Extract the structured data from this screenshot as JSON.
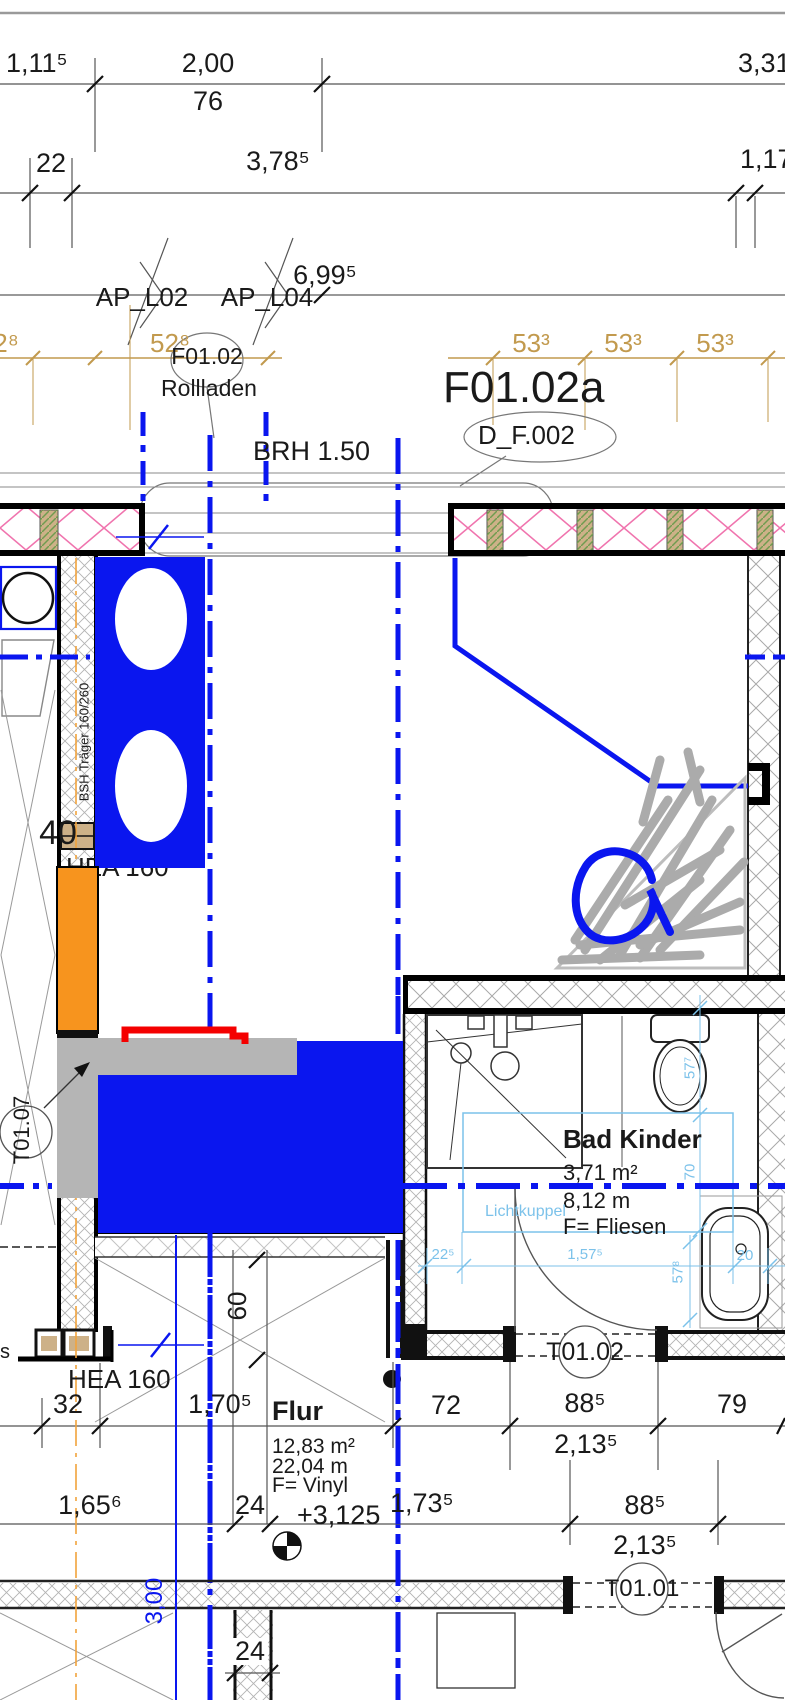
{
  "top_dims": {
    "r1a": "1,11⁵",
    "r1b": "2,00",
    "r1b_sub": "76",
    "r1c": "3,31",
    "r2a": "22",
    "r2b": "3,78⁵",
    "r2c": "1,17",
    "r3a": "6,99⁵"
  },
  "ap_labels": {
    "l02": "AP_L02",
    "l04": "AP_L04"
  },
  "gold_dims": {
    "g0": "2⁸",
    "g1": "52⁸",
    "g2": "53³",
    "g3": "53³",
    "g4": "53³"
  },
  "window": {
    "tag": "F01.02",
    "shutter": "Rollladen",
    "sill": "BRH 1.50",
    "tag_a": "F01.02a",
    "door_ref": "D_F.002"
  },
  "beams": {
    "bsh": "BSH Träger 160/260",
    "hea_hidden": "HEA 160",
    "hea": "HEA 160",
    "w40": "40",
    "d60": "60"
  },
  "doors": {
    "t0107": "T01.07",
    "t0102": "T01.02",
    "t0101": "T01.01"
  },
  "bath": {
    "name": "Bad Kinder",
    "area": "3,71 m²",
    "perim": "8,12 m",
    "floor": "F= Fliesen",
    "skylight": "Lichtkuppel",
    "c_dims": {
      "v1": "57⁷",
      "v2": "70",
      "h1": "22⁵",
      "h2": "1,57⁵",
      "h3": "20",
      "v3": "57⁸"
    }
  },
  "flur": {
    "name": "Flur",
    "area": "12,83 m²",
    "perim": "22,04 m",
    "floor": "F= Vinyl",
    "level": "+3,125",
    "axis": "3,00"
  },
  "bot_dims": {
    "b32": "32",
    "b1705": "1,70⁵",
    "b72": "72",
    "b885a": "88⁵",
    "b79": "79",
    "b2135a": "2,13⁵",
    "b1656": "1,65⁶",
    "b24a": "24",
    "b1735": "1,73⁵",
    "b885b": "88⁵",
    "b2135b": "2,13⁵",
    "b24b": "24",
    "frag": "s"
  },
  "colors": {
    "blue": "#0a16ef",
    "cyan": "#7cc2ea",
    "gold": "#c29a4e",
    "orange": "#f7941e",
    "red": "#f40000",
    "gray": "#b5b5b5",
    "pink": "#f074ae"
  }
}
